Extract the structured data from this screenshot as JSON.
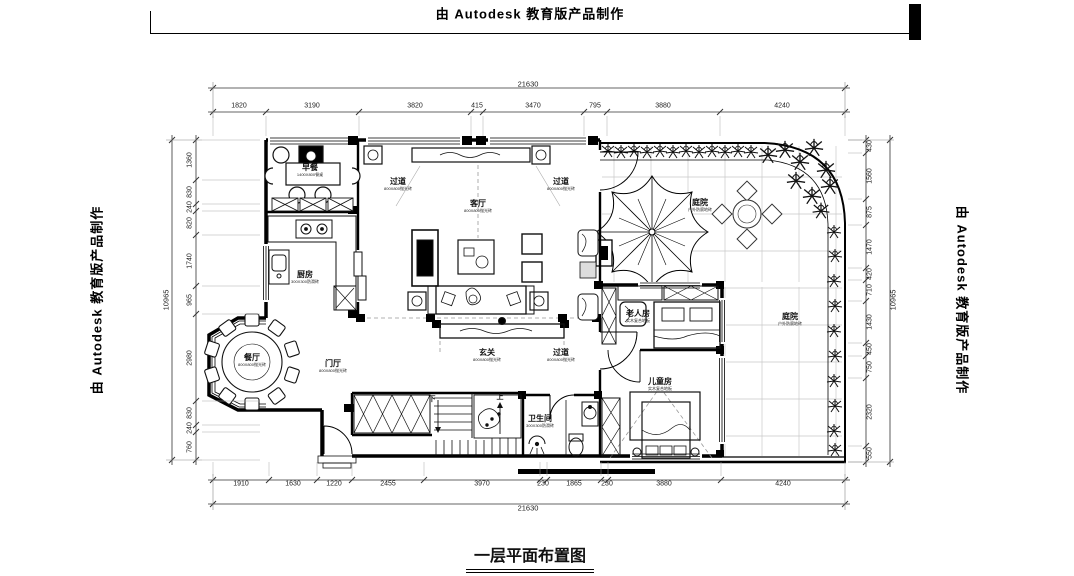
{
  "watermark": {
    "text": "由 Autodesk 教育版产品制作"
  },
  "title": {
    "text": "一层平面布置图"
  },
  "plan": {
    "room_labels": [
      {
        "name": "breakfast-area",
        "label": "早餐",
        "sub": "1400X800餐桌",
        "x": 310,
        "y": 170
      },
      {
        "name": "passage-top-left",
        "label": "过道",
        "sub": "800X800抛光砖",
        "x": 398,
        "y": 184
      },
      {
        "name": "living-room",
        "label": "客厅",
        "sub": "800X800抛光砖",
        "x": 478,
        "y": 206
      },
      {
        "name": "passage-top-right",
        "label": "过道",
        "sub": "800X800抛光砖",
        "x": 561,
        "y": 184
      },
      {
        "name": "kitchen",
        "label": "厨房",
        "sub": "300X300防滑砖",
        "x": 305,
        "y": 277
      },
      {
        "name": "dining-room",
        "label": "餐厅",
        "sub": "800X800抛光砖",
        "x": 252,
        "y": 360
      },
      {
        "name": "foyer",
        "label": "门厅",
        "sub": "800X800抛光砖",
        "x": 333,
        "y": 366
      },
      {
        "name": "entry-hall",
        "label": "玄关",
        "sub": "800X800抛光砖",
        "x": 487,
        "y": 355
      },
      {
        "name": "passage-bottom",
        "label": "过道",
        "sub": "800X800抛光砖",
        "x": 561,
        "y": 355
      },
      {
        "name": "elderly-room",
        "label": "老人房",
        "sub": "实木复合地板",
        "x": 638,
        "y": 316
      },
      {
        "name": "children-room",
        "label": "儿童房",
        "sub": "实木复合地板",
        "x": 660,
        "y": 384
      },
      {
        "name": "bathroom",
        "label": "卫生间",
        "sub": "300X300防滑砖",
        "x": 540,
        "y": 421
      },
      {
        "name": "courtyard-upper",
        "label": "庭院",
        "sub": "户外防腐地砖",
        "x": 700,
        "y": 205
      },
      {
        "name": "courtyard-lower",
        "label": "庭院",
        "sub": "户外防腐地砖",
        "x": 790,
        "y": 319
      }
    ],
    "stair_labels": [
      {
        "text": "下",
        "x": 432,
        "y": 399
      },
      {
        "text": "上",
        "x": 500,
        "y": 397
      }
    ]
  },
  "dimensions": {
    "top_total": {
      "t": "21630",
      "x": 528,
      "y": 84
    },
    "bottom_total": {
      "t": "21630",
      "x": 528,
      "y": 508
    },
    "left_total": {
      "t": "10965",
      "x": 166,
      "y": 300
    },
    "right_total": {
      "t": "10965",
      "x": 893,
      "y": 300
    },
    "top": [
      {
        "t": "1820",
        "x": 239
      },
      {
        "t": "3190",
        "x": 312
      },
      {
        "t": "3820",
        "x": 415
      },
      {
        "t": "415",
        "x": 477
      },
      {
        "t": "3470",
        "x": 533
      },
      {
        "t": "795",
        "x": 595
      },
      {
        "t": "3880",
        "x": 663
      },
      {
        "t": "4240",
        "x": 782
      }
    ],
    "bottom": [
      {
        "t": "1910",
        "x": 241
      },
      {
        "t": "1630",
        "x": 293
      },
      {
        "t": "1220",
        "x": 334
      },
      {
        "t": "2455",
        "x": 388
      },
      {
        "t": "3970",
        "x": 482
      },
      {
        "t": "230",
        "x": 543
      },
      {
        "t": "1865",
        "x": 574
      },
      {
        "t": "230",
        "x": 607
      },
      {
        "t": "3880",
        "x": 664
      },
      {
        "t": "4240",
        "x": 783
      }
    ],
    "left": [
      {
        "t": "1360",
        "y": 160
      },
      {
        "t": "830",
        "y": 192
      },
      {
        "t": "240",
        "y": 207
      },
      {
        "t": "820",
        "y": 223
      },
      {
        "t": "1740",
        "y": 261
      },
      {
        "t": "965",
        "y": 300
      },
      {
        "t": "2980",
        "y": 358
      },
      {
        "t": "830",
        "y": 413
      },
      {
        "t": "240",
        "y": 428
      },
      {
        "t": "760",
        "y": 447
      }
    ],
    "right": [
      {
        "t": "430",
        "y": 146
      },
      {
        "t": "1560",
        "y": 176
      },
      {
        "t": "875",
        "y": 212
      },
      {
        "t": "1470",
        "y": 247
      },
      {
        "t": "420",
        "y": 274
      },
      {
        "t": "710",
        "y": 290
      },
      {
        "t": "1430",
        "y": 322
      },
      {
        "t": "450",
        "y": 349
      },
      {
        "t": "750",
        "y": 367
      },
      {
        "t": "2320",
        "y": 412
      },
      {
        "t": "550",
        "y": 453
      }
    ],
    "chains": [
      {
        "o": "h",
        "pos": 112,
        "a": 213,
        "b": 845,
        "ticks": [
          213,
          266,
          359,
          471,
          483,
          584,
          607,
          720,
          845
        ],
        "wit": [
          116,
          136
        ]
      },
      {
        "o": "h",
        "pos": 88,
        "a": 213,
        "b": 845,
        "ticks": [
          213,
          845
        ]
      },
      {
        "o": "h",
        "pos": 480,
        "a": 213,
        "b": 845,
        "ticks": [
          213,
          269,
          317,
          352,
          424,
          540,
          547,
          601,
          608,
          721,
          845
        ],
        "wit": [
          462,
          476
        ]
      },
      {
        "o": "h",
        "pos": 504,
        "a": 213,
        "b": 845,
        "ticks": [
          213,
          845
        ]
      },
      {
        "o": "v",
        "pos": 196,
        "a": 140,
        "b": 460,
        "ticks": [
          140,
          180,
          204,
          211,
          235,
          286,
          314,
          401,
          425,
          432,
          460
        ],
        "wit": [
          202,
          260
        ]
      },
      {
        "o": "v",
        "pos": 172,
        "a": 140,
        "b": 460,
        "ticks": [
          140,
          460
        ]
      },
      {
        "o": "v",
        "pos": 866,
        "a": 140,
        "b": 462,
        "ticks": [
          140,
          153,
          199,
          225,
          268,
          280,
          301,
          343,
          356,
          378,
          446,
          462
        ],
        "wit": [
          848,
          862
        ]
      },
      {
        "o": "v",
        "pos": 890,
        "a": 140,
        "b": 462,
        "ticks": [
          140,
          462
        ]
      }
    ]
  },
  "colors": {
    "line": "#000000",
    "grid": "#c8c8c8",
    "dash": "#999999",
    "white": "#ffffff"
  }
}
